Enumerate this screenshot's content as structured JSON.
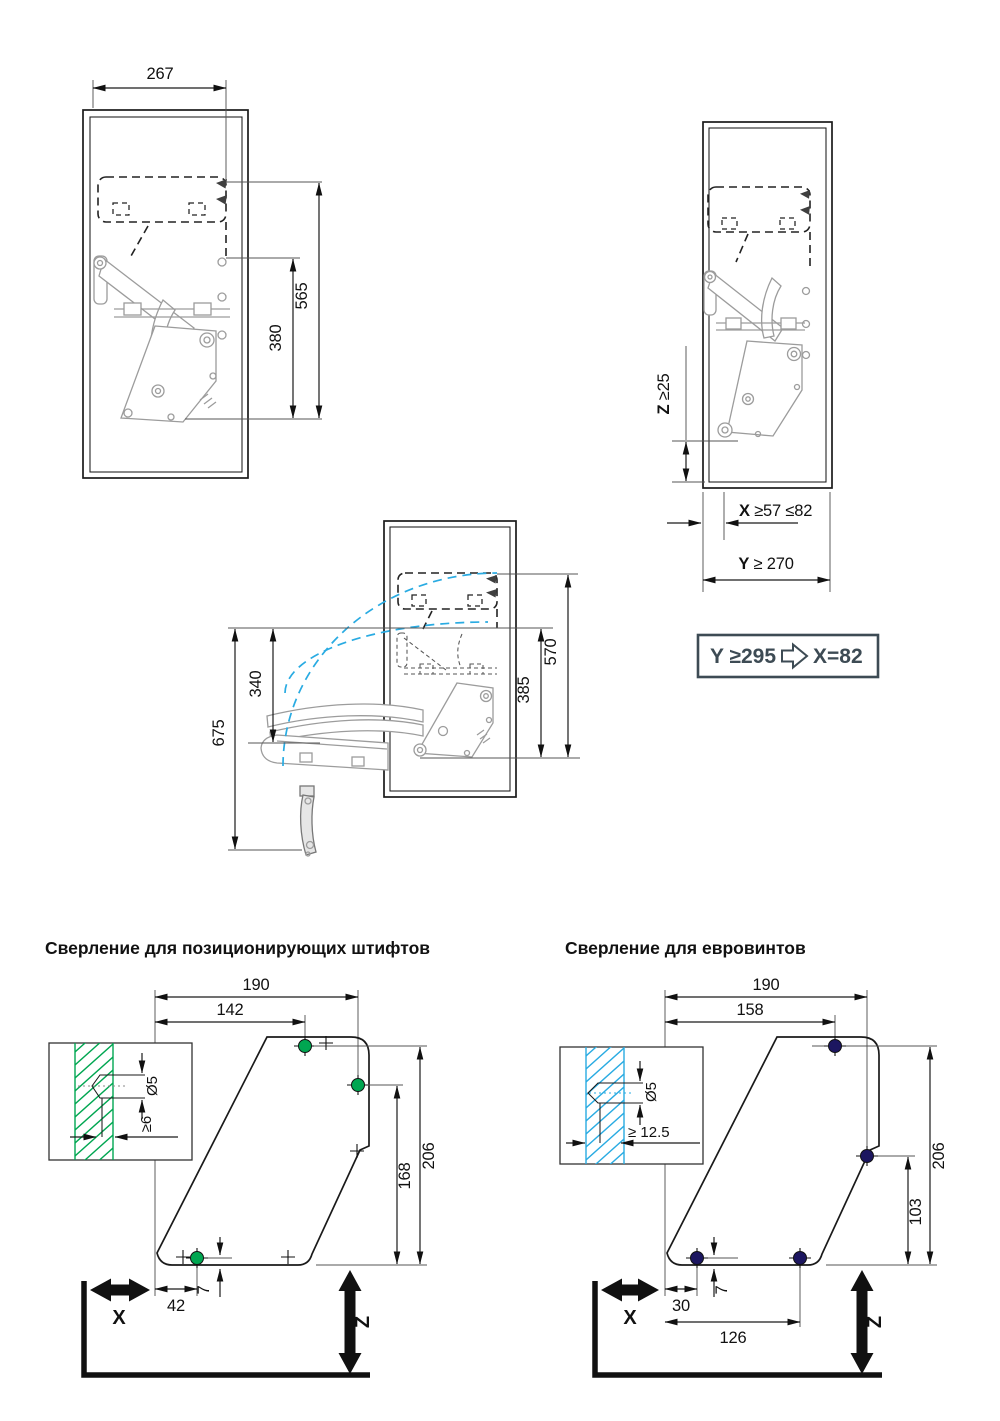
{
  "colors": {
    "green": "#00a651",
    "blue": "#29abe2",
    "navy": "#1c1660",
    "slate": "#3d4b54",
    "ink": "#1a1a1a",
    "gray": "#9c9c9c"
  },
  "closed_view": {
    "width": "267",
    "height_top": "565",
    "height_mech": "380"
  },
  "side_view": {
    "z_label": "Z",
    "z_value": " ≥25",
    "x_label": "X",
    "x_value": " ≥57 ≤82",
    "y_label": "Y",
    "y_value": " ≥ 270"
  },
  "open_view": {
    "reach_total": "675",
    "reach_door": "340",
    "drop_mech": "385",
    "drop_door": "570"
  },
  "formula": {
    "condition": "Y ≥295",
    "result": "X=82"
  },
  "drill_pins": {
    "title": "Сверление для позиционирующих штифтов",
    "width": "190",
    "hole_top_x": "142",
    "height": "206",
    "hole_side_y": "168",
    "hole_bottom_x": "42",
    "edge_offset": "7",
    "x_label": "X",
    "z_label": "Z",
    "diameter": "Ø5",
    "depth": "≥6"
  },
  "drill_euro": {
    "title": "Сверление для евровинтов",
    "width": "190",
    "hole_top_x": "158",
    "height": "206",
    "hole_side_y": "103",
    "hole_bottom_x": "30",
    "hole_spacing": "126",
    "edge_offset": "7",
    "x_label": "X",
    "z_label": "Z",
    "diameter": "Ø5",
    "depth": "≥ 12.5"
  }
}
